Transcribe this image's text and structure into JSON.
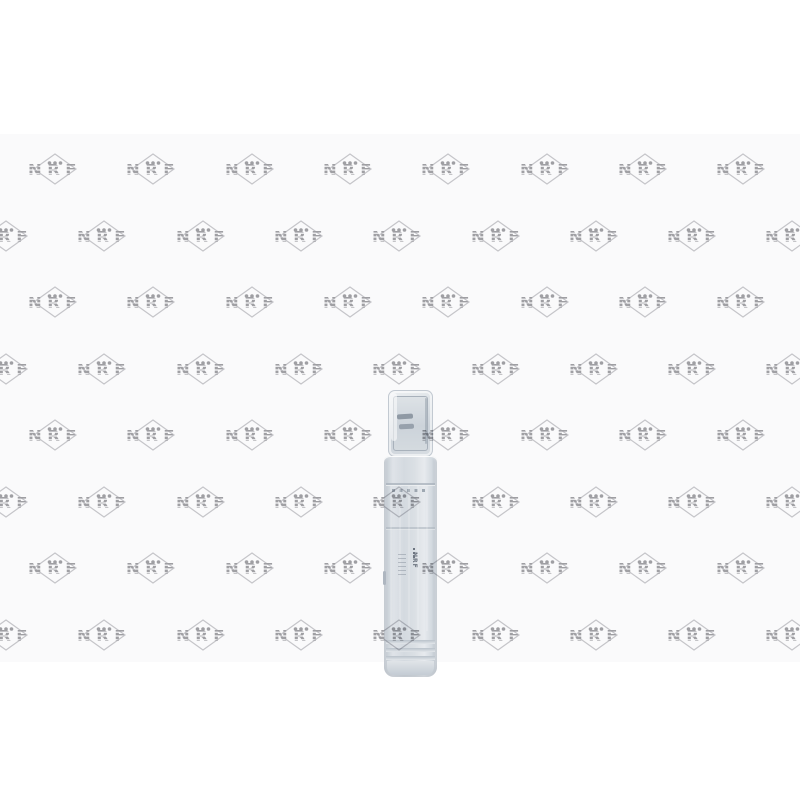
{
  "page": {
    "background_color": "#ffffff",
    "photo_area_color": "#fafafb"
  },
  "watermark": {
    "brand": "NRF",
    "letter_color": "#a2a2a6",
    "diamond_color": "#c9c9cd",
    "dot_color": "#a2a2a6"
  },
  "product": {
    "side_print": "NRF"
  }
}
